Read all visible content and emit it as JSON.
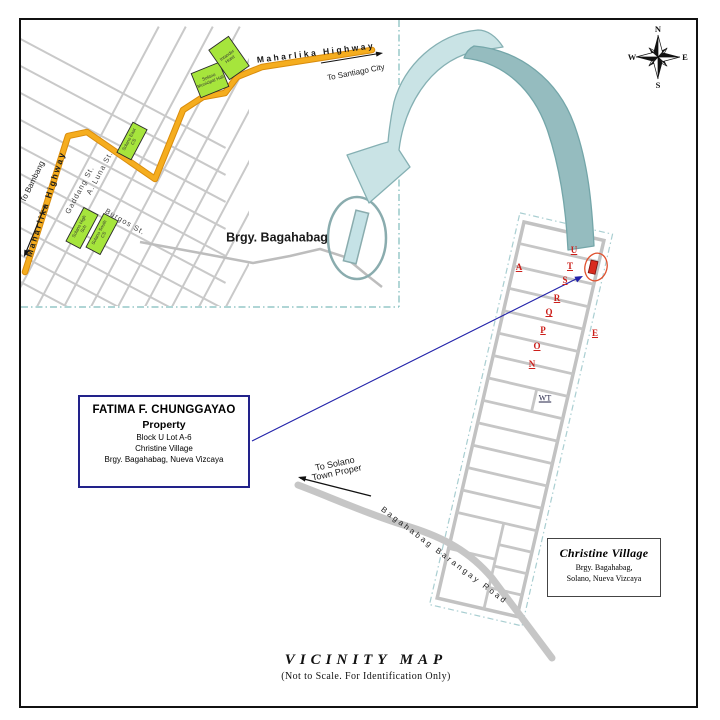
{
  "document": {
    "title": "VICINITY MAP",
    "subtitle": "(Not to Scale. For Identification Only)"
  },
  "compass": {
    "n": "N",
    "e": "E",
    "s": "S",
    "w": "W"
  },
  "inset_map": {
    "highway_top_label": "Maharlika Highway",
    "highway_left_label": "Maharlika Highway",
    "to_santiago_label": "To Santiago City",
    "to_bambang_label": "To Bambang",
    "street_gaddang": "Gaddang St.",
    "street_a_luna": "A. Luna St.",
    "street_burgos": "Burgos St.",
    "bldg_municipal_hall": "Solano Municipal Hall",
    "bldg_hotel": "Intander Hotel",
    "bldg_east_cs": "Solano East CS",
    "bldg_high_school": "Solano High Sch",
    "bldg_south_cs": "Solano South CS",
    "barangay_label": "Brgy. Bagahabag"
  },
  "property_box": {
    "owner": "FATIMA F. CHUNGGAYAO",
    "type_label": "Property",
    "lot_line": "Block U Lot A-6",
    "village_line": "Christine Village",
    "address_line": "Brgy. Bagahabag, Nueva Vizcaya"
  },
  "village_box": {
    "name": "Christine Village",
    "address_line1": "Brgy. Bagahabag,",
    "address_line2": "Solano, Nueva Vizcaya"
  },
  "road_labels": {
    "to_solano_line1": "To Solano",
    "to_solano_line2": "Town Proper",
    "barangay_road": "Bagahabag Barangay Road"
  },
  "subdivision": {
    "block_labels": [
      "A",
      "U",
      "T",
      "S",
      "R",
      "Q",
      "P",
      "O",
      "N",
      "E"
    ],
    "water_tank_label": "WT"
  },
  "colors": {
    "highway_yellow": "#f0a818",
    "building_green": "#a6e53c",
    "arrow_light_teal": "#c9e3e5",
    "arrow_dark_teal": "#95bcbf",
    "teal_stroke": "#85b0b3",
    "road_gray": "#c6c6c6",
    "block_letter_red": "#cc1f1a",
    "marker_red": "#d92b1f",
    "property_border_navy": "#22228a",
    "pointer_blue": "#2222aa"
  }
}
